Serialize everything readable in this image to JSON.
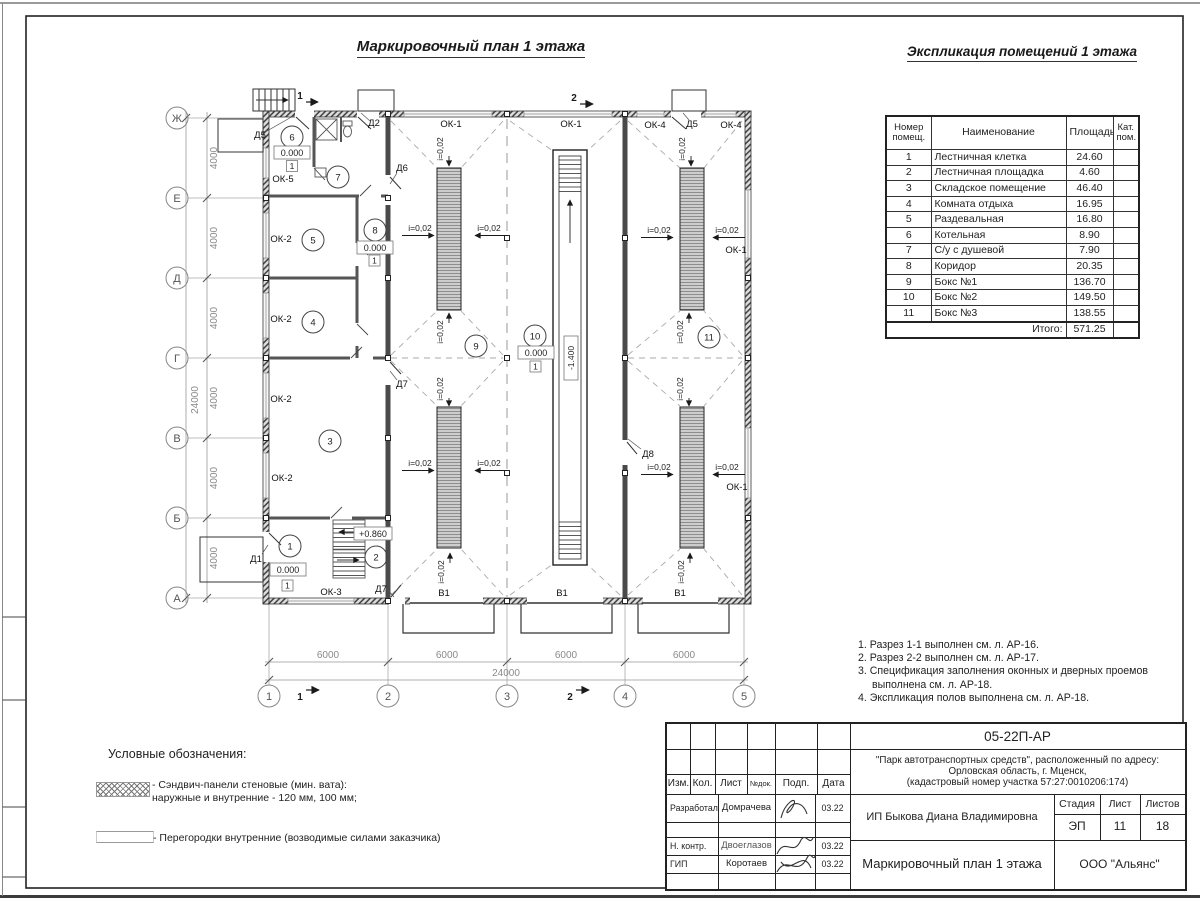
{
  "sheet": {
    "plan_title": "Маркировочный план 1 этажа",
    "table_title": "Экспликация помещений 1 этажа"
  },
  "plan": {
    "row_axes": [
      "Ж",
      "Е",
      "Д",
      "Г",
      "В",
      "Б",
      "А"
    ],
    "col_axes": [
      "1",
      "2",
      "3",
      "4",
      "5"
    ],
    "dim_step_v": "4000",
    "dim_step_h": "6000",
    "dim_total": "24000",
    "slope": "i=0,02",
    "level_zero": "0.000",
    "level_stair": "+0.860",
    "level_pit": "-1.400",
    "floor_type": "1",
    "rooms": [
      "1",
      "2",
      "3",
      "4",
      "5",
      "6",
      "7",
      "8",
      "9",
      "10",
      "11"
    ],
    "win": {
      "ok1": "ОК-1",
      "ok2": "ОК-2",
      "ok3": "ОК-3",
      "ok4": "ОК-4",
      "ok5": "ОК-5"
    },
    "door": {
      "d1": "Д1",
      "d2": "Д2",
      "d5": "Д5",
      "d6": "Д6",
      "d7": "Д7",
      "d8": "Д8"
    },
    "gate": "В1",
    "sec1": "1",
    "sec2": "2"
  },
  "table": {
    "headers": {
      "num": "Номер помещ.",
      "name": "Наименование",
      "area": "Площадь",
      "cat": "Кат. пом."
    },
    "rows": [
      {
        "num": "1",
        "name": "Лестничная клетка",
        "area": "24.60"
      },
      {
        "num": "2",
        "name": "Лестничная площадка",
        "area": "4.60"
      },
      {
        "num": "3",
        "name": "Складское помещение",
        "area": "46.40"
      },
      {
        "num": "4",
        "name": "Комната отдыха",
        "area": "16.95"
      },
      {
        "num": "5",
        "name": "Раздевальная",
        "area": "16.80"
      },
      {
        "num": "6",
        "name": "Котельная",
        "area": "8.90"
      },
      {
        "num": "7",
        "name": "С/у с душевой",
        "area": "7.90"
      },
      {
        "num": "8",
        "name": "Коридор",
        "area": "20.35"
      },
      {
        "num": "9",
        "name": "Бокс №1",
        "area": "136.70"
      },
      {
        "num": "10",
        "name": "Бокс №2",
        "area": "149.50"
      },
      {
        "num": "11",
        "name": "Бокс №3",
        "area": "138.55"
      }
    ],
    "total_label": "Итого:",
    "total": "571.25"
  },
  "notes": [
    "1. Разрез 1-1 выполнен см. л. АР-16.",
    "2. Разрез 2-2 выполнен см. л. АР-17.",
    "3. Спецификация заполнения оконных и дверных проемов выполнена см. л. АР-18.",
    "4. Экспликация полов выполнена см. л. АР-18."
  ],
  "legend": {
    "title": "Условные обозначения:",
    "item1": "- Сэндвич-панели стеновые (мин. вата):\nнаружные и внутренние - 120 мм, 100 мм;",
    "item2": "- Перегородки внутренние (возводимые силами заказчика)"
  },
  "titleblock": {
    "doc_number": "05-22П-АР",
    "project1": "\"Парк автотранспортных средств\",  расположенный по адресу:",
    "project2": "Орловская область, г. Мценск,",
    "project3": "(кадастровый номер участка 57:27:0010206:174)",
    "client": "ИП Быкова Диана Владимировна",
    "sheet_title": "Маркировочный план 1 этажа",
    "company": "ООО \"Альянс\"",
    "stage_label": "Стадия",
    "sheet_label": "Лист",
    "sheets_label": "Листов",
    "stage": "ЭП",
    "sheet_num": "11",
    "sheets_total": "18",
    "cols": [
      "Изм.",
      "Кол.",
      "Лист",
      "№док.",
      "Подп.",
      "Дата"
    ],
    "rows": [
      {
        "role": "Разработал",
        "name": "Домрачева",
        "date": "03.22"
      },
      {
        "role": "Н. контр.",
        "name": "Двоеглазов",
        "date": "03.22"
      },
      {
        "role": "ГИП",
        "name": "Коротаев",
        "date": "03.22"
      }
    ]
  }
}
